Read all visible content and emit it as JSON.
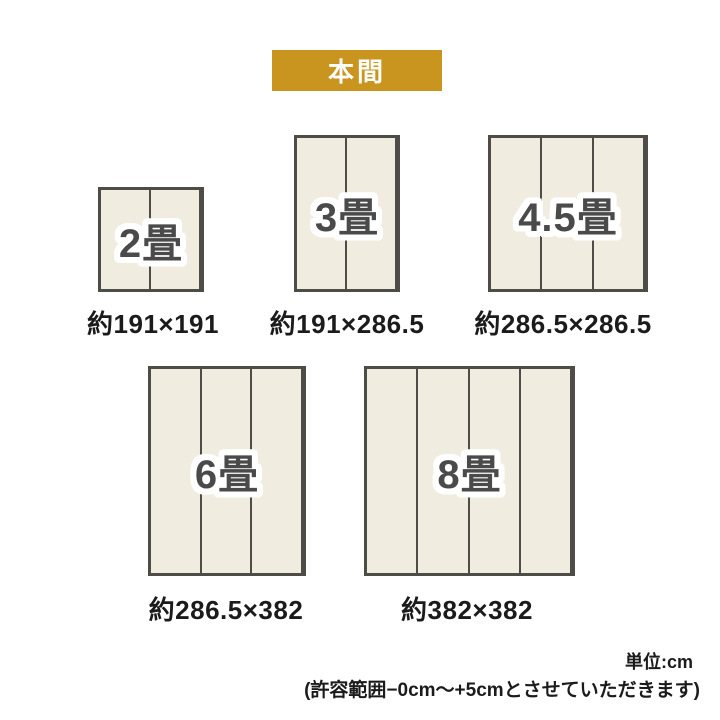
{
  "header": {
    "badge_label": "本間"
  },
  "colors": {
    "badge_background": "#c9951f",
    "badge_text": "#ffffff",
    "mat_fill": "#f0ede0",
    "mat_border": "#4d4c46",
    "mat_label_text": "#4a4a4a",
    "caption_text": "#1b1b1b",
    "page_background": "#ffffff"
  },
  "mats": [
    {
      "id": "2jo",
      "label": "2畳",
      "size_note": "約191×191",
      "panels": 2
    },
    {
      "id": "3jo",
      "label": "3畳",
      "size_note": "約191×286.5",
      "panels": 2
    },
    {
      "id": "45jo",
      "label": "4.5畳",
      "size_note": "約286.5×286.5",
      "panels": 3
    },
    {
      "id": "6jo",
      "label": "6畳",
      "size_note": "約286.5×382",
      "panels": 3
    },
    {
      "id": "8jo",
      "label": "8畳",
      "size_note": "約382×382",
      "panels": 4
    }
  ],
  "footer": {
    "unit_label": "単位:cm",
    "tolerance_note": "(許容範囲−0cm〜+5cmとさせていただきます)"
  }
}
